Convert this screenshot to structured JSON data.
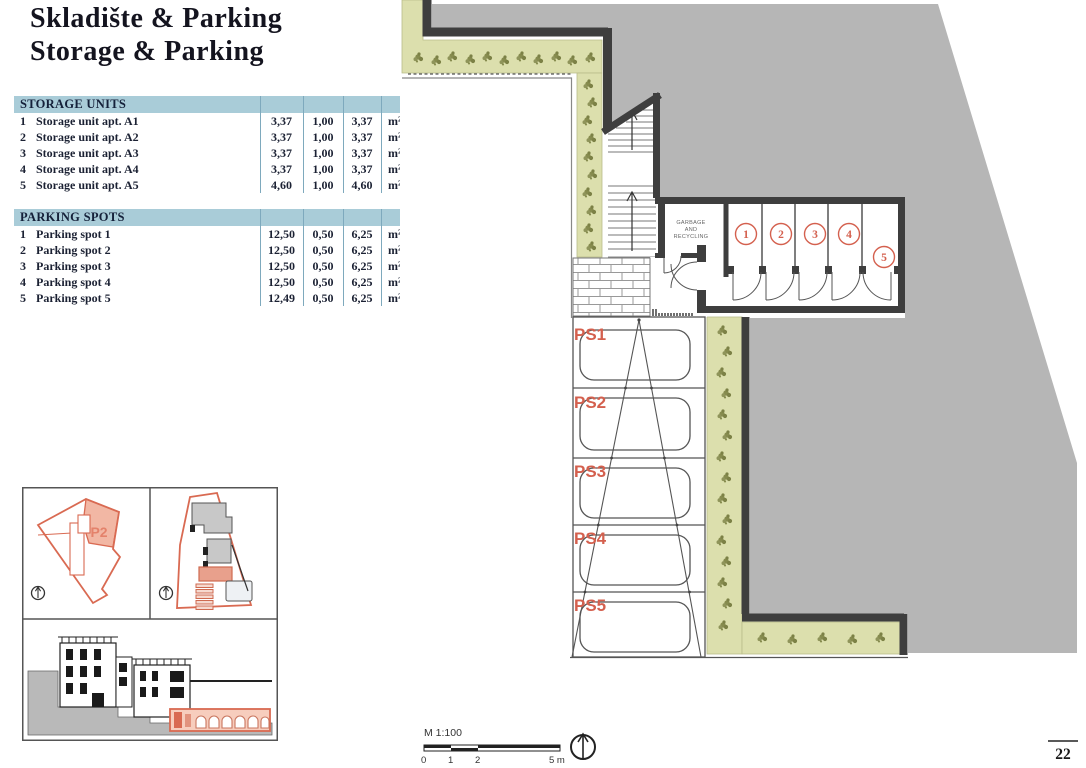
{
  "page": {
    "title_line1": "Skladište & Parking",
    "title_line2": "Storage & Parking",
    "page_number": "22"
  },
  "tables": {
    "storage": {
      "header": "STORAGE UNITS",
      "rows": [
        {
          "num": "1",
          "name": "Storage unit apt. A1",
          "area": "3,37",
          "coef": "1,00",
          "total": "3,37",
          "unit": "m²"
        },
        {
          "num": "2",
          "name": "Storage unit apt. A2",
          "area": "3,37",
          "coef": "1,00",
          "total": "3,37",
          "unit": "m²"
        },
        {
          "num": "3",
          "name": "Storage unit apt. A3",
          "area": "3,37",
          "coef": "1,00",
          "total": "3,37",
          "unit": "m²"
        },
        {
          "num": "4",
          "name": "Storage unit apt. A4",
          "area": "3,37",
          "coef": "1,00",
          "total": "3,37",
          "unit": "m²"
        },
        {
          "num": "5",
          "name": "Storage unit apt. A5",
          "area": "4,60",
          "coef": "1,00",
          "total": "4,60",
          "unit": "m²"
        }
      ]
    },
    "parking": {
      "header": "PARKING SPOTS",
      "rows": [
        {
          "num": "1",
          "name": "Parking spot 1",
          "area": "12,50",
          "coef": "0,50",
          "total": "6,25",
          "unit": "m²"
        },
        {
          "num": "2",
          "name": "Parking spot 2",
          "area": "12,50",
          "coef": "0,50",
          "total": "6,25",
          "unit": "m²"
        },
        {
          "num": "3",
          "name": "Parking spot 3",
          "area": "12,50",
          "coef": "0,50",
          "total": "6,25",
          "unit": "m²"
        },
        {
          "num": "4",
          "name": "Parking spot 4",
          "area": "12,50",
          "coef": "0,50",
          "total": "6,25",
          "unit": "m²"
        },
        {
          "num": "5",
          "name": "Parking spot 5",
          "area": "12,49",
          "coef": "0,50",
          "total": "6,25",
          "unit": "m²"
        }
      ]
    }
  },
  "plan": {
    "garbage_label_lines": [
      "GARBAGE",
      "AND",
      "RECYCLING"
    ],
    "storage_unit_numbers": [
      "1",
      "2",
      "3",
      "4",
      "5"
    ],
    "parking_spot_labels": [
      "PS1",
      "PS2",
      "PS3",
      "PS4",
      "PS5"
    ],
    "colors": {
      "site_gray": "#b6b6b6",
      "greenery": "#dcdfad",
      "plant_olive": "#868b4e",
      "wall_dark": "#3e3e3e",
      "accent_red": "#d4604e",
      "table_header_blue": "#a9ccd8",
      "table_rule_blue": "#7ea9bd",
      "inset_orange": "#d96a52"
    }
  },
  "insets": {
    "site_parcel_label": "P2"
  },
  "scalebar": {
    "label": "M 1:100",
    "ticks": [
      "0",
      "1",
      "2",
      "5 m"
    ]
  }
}
